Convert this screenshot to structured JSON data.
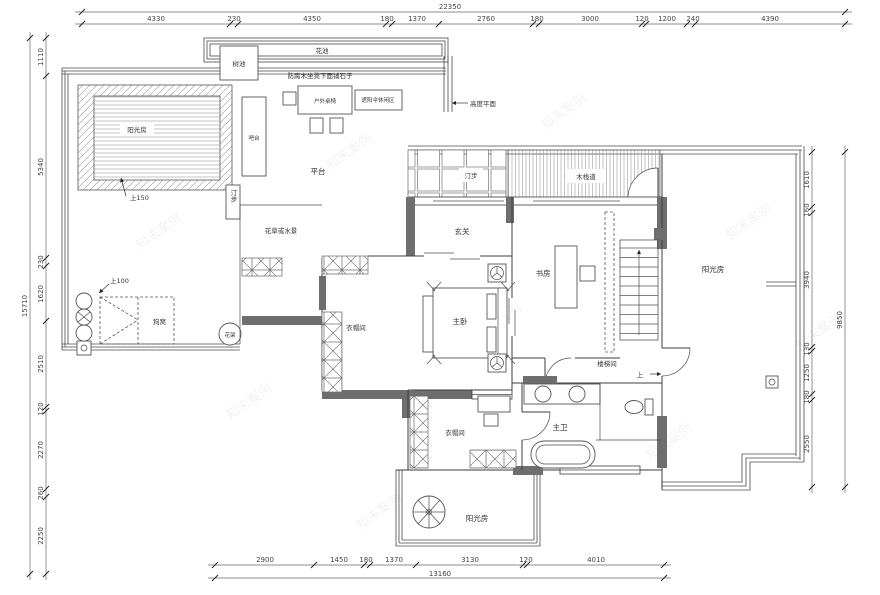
{
  "watermark": "知末案例",
  "dims": {
    "top": {
      "total": "22350",
      "segs": [
        "4330",
        "230",
        "4350",
        "180",
        "1370",
        "2760",
        "180",
        "3000",
        "120",
        "1200",
        "240",
        "4390"
      ]
    },
    "left": {
      "total": "15710",
      "segs": [
        "1110",
        "5340",
        "230",
        "1620",
        "2510",
        "120",
        "2270",
        "260",
        "2250"
      ]
    },
    "right": {
      "total": "9850",
      "segs": [
        "1610",
        "160",
        "3940",
        "130",
        "1250",
        "180",
        "2550"
      ]
    },
    "bottom": {
      "total": "13160",
      "segs": [
        "2900",
        "1450",
        "180",
        "1370",
        "3130",
        "120",
        "4010"
      ]
    }
  },
  "rooms": {
    "sunroom_topleft": "阳光房",
    "sunroom_right": "阳光房",
    "sunroom_bottom": "阳光房",
    "bar": "吧台",
    "platform": "平台",
    "entry": "玄关",
    "study": "书房",
    "master_bedroom": "主卧",
    "cloakroom_1": "衣帽间",
    "cloakroom_2": "衣帽间",
    "master_bath": "主卫",
    "stairwell": "楼梯间"
  },
  "notes": {
    "flower_bed": "花池",
    "tree_pool": "树池",
    "bench_note": "防腐木坐凳下面铺石子",
    "outdoor_table": "户外桌椅",
    "parasol_area": "遮阳伞休闲区",
    "height_note": "高度平面",
    "stepping_1": "汀步",
    "stepping_2": "汀步",
    "flower_or_water": "花草或水景",
    "boardwalk": "木栈道",
    "dog_house": "狗窝",
    "flower_rack": "花架",
    "up_150": "上150",
    "up_100": "上100",
    "up": "上"
  }
}
